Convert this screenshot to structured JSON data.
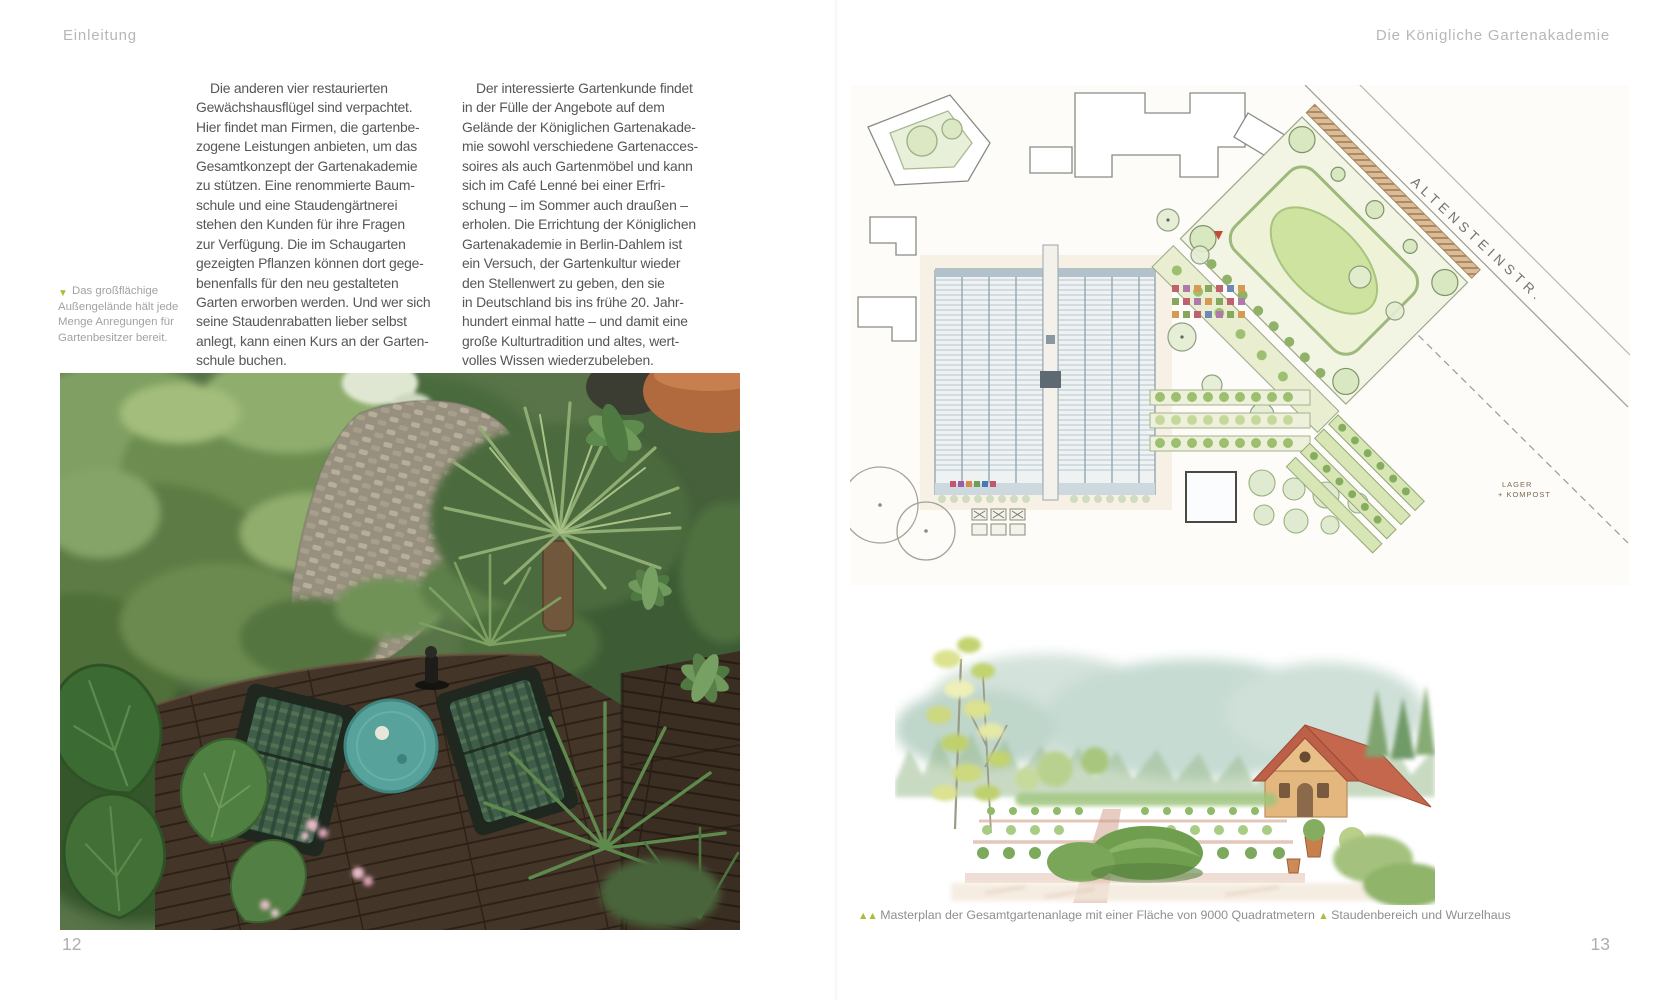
{
  "page_left": {
    "header": "Einleitung",
    "page_number": "12",
    "column1_lines": [
      "Die anderen vier restaurierten",
      "Gewächshausflügel sind verpachtet.",
      "Hier findet man Firmen, die gartenbe-",
      "zogene Leistungen anbieten, um das",
      "Gesamtkonzept der Gartenakademie",
      "zu stützen. Eine renommierte Baum-",
      "schule und eine Staudengärtnerei",
      "stehen den Kunden für ihre Fragen",
      "zur Verfügung. Die im Schaugarten",
      "gezeigten Pflanzen können dort gege-",
      "benenfalls für den neu gestalteten",
      "Garten erworben werden. Und wer sich",
      "seine Staudenrabatten lieber selbst",
      "anlegt, kann einen Kurs an der Garten-",
      "schule buchen."
    ],
    "column2_lines": [
      "Der interessierte Gartenkunde findet",
      "in der Fülle der Angebote auf dem",
      "Gelände der Königlichen Gartenakade-",
      "mie sowohl verschiedene Gartenacces-",
      "soires als auch Gartenmöbel und kann",
      "sich im Café Lenné bei einer Erfri-",
      "schung – im Sommer auch draußen –",
      "erholen. Die Errichtung der Königlichen",
      "Gartenakademie in Berlin-Dahlem ist",
      "ein Versuch, der Gartenkultur wieder",
      "den Stellenwert zu geben, den sie",
      "in Deutschland bis ins frühe 20. Jahr-",
      "hundert einmal hatte – und damit eine",
      "große Kulturtradition und altes, wert-",
      "volles Wissen wiederzubeleben."
    ],
    "margin_caption": {
      "marker": "▼",
      "lines": [
        "Das großflächige",
        "Außengelände hält jede",
        "Menge Anregungen für",
        "Gartenbesitzer bereit."
      ]
    }
  },
  "page_right": {
    "header": "Die Königliche Gartenakademie",
    "page_number": "13",
    "plan": {
      "street_label": "ALTENSTEINSTR.",
      "storage_label_line1": "LAGER",
      "storage_label_line2": "+ KOMPOST"
    },
    "caption": {
      "marker1": "▲▲",
      "text1": " Masterplan der Gesamtgartenanlage mit einer Fläche von 9000 Quadratmetern ",
      "marker2": "▲",
      "text2": " Staudenbereich und Wurzelhaus"
    }
  },
  "colors": {
    "accent_green": "#a6bf3c",
    "heading_gray": "#b7b7b7",
    "body_gray": "#565656",
    "caption_gray": "#8f8f8f"
  }
}
